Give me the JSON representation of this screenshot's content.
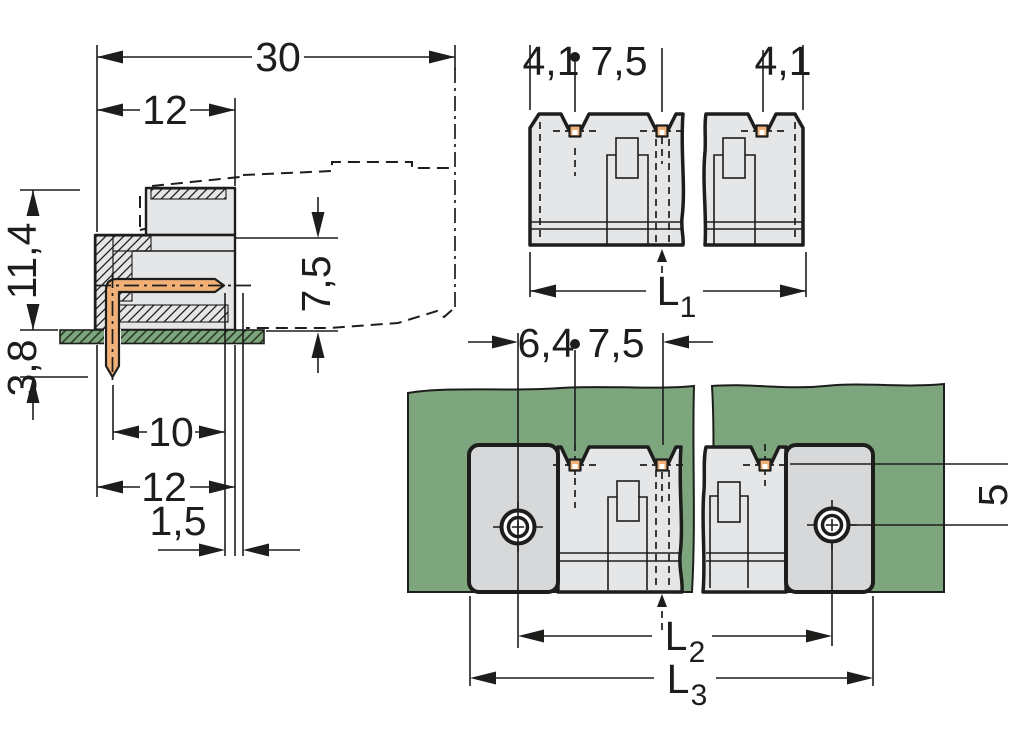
{
  "colors": {
    "line": "#1d1d1b",
    "housing_fill": "#e4e6e7",
    "flange_fill": "#d6d8d9",
    "pcb_green": "#7ea67e",
    "hatch_green_line": "#2a3a26",
    "pin_copper": "#f0b078",
    "background": "#ffffff"
  },
  "side_view": {
    "overall_depth": "30",
    "housing_depth": "12",
    "height_above_pcb": "11,4",
    "pin_length_below_pcb": "3,8",
    "mating_face_height": "7,5",
    "pin_depth": "10",
    "body_depth": "12",
    "face_offset": "1,5"
  },
  "header_view": {
    "edge_to_first_pin": "4,1",
    "pin_pitch": "7,5",
    "last_pin_to_edge": "4,1",
    "total_length": {
      "base": "L",
      "sub": "1"
    }
  },
  "pcb_view": {
    "screw_to_first_pin": "6,4",
    "pin_pitch": "7,5",
    "pin_row_to_screw_axis": "5",
    "screw_spacing": {
      "base": "L",
      "sub": "2"
    },
    "overall_length": {
      "base": "L",
      "sub": "3"
    }
  }
}
